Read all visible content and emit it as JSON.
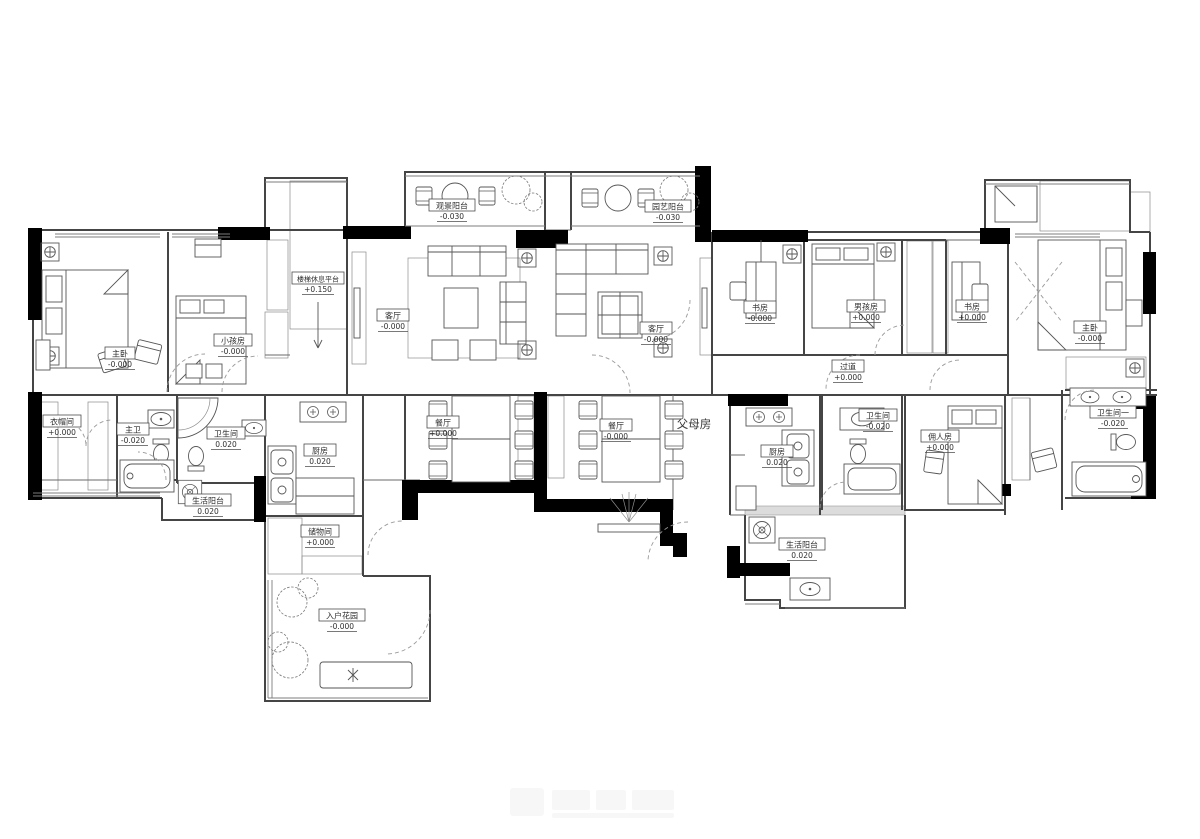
{
  "plan": {
    "rooms": {
      "master_left": {
        "name": "主卧",
        "elev": "-0.000"
      },
      "kids_room": {
        "name": "小孩房",
        "elev": "-0.000"
      },
      "stair_landing": {
        "name": "楼梯休息平台",
        "elev": "+0.150"
      },
      "view_balcony": {
        "name": "观景阳台",
        "elev": "-0.030"
      },
      "garden_balcony": {
        "name": "园艺阳台",
        "elev": "-0.030"
      },
      "living_left": {
        "name": "客厅",
        "elev": "-0.000"
      },
      "living_right": {
        "name": "客厅",
        "elev": "-0.000"
      },
      "study_left": {
        "name": "书房",
        "elev": "-0.000"
      },
      "boys_room": {
        "name": "男孩房",
        "elev": "+0.000"
      },
      "study_right": {
        "name": "书房",
        "elev": "+0.000"
      },
      "master_right": {
        "name": "主卧",
        "elev": "-0.000"
      },
      "hallway": {
        "name": "过道",
        "elev": "+0.000"
      },
      "cloakroom": {
        "name": "衣帽间",
        "elev": "+0.000"
      },
      "master_bath": {
        "name": "主卫",
        "elev": "-0.020"
      },
      "bath_left": {
        "name": "卫生间",
        "elev": "0.020"
      },
      "service_balcony_left": {
        "name": "生活阳台",
        "elev": "0.020"
      },
      "kitchen_left": {
        "name": "厨房",
        "elev": "0.020"
      },
      "storage": {
        "name": "储物间",
        "elev": "+0.000"
      },
      "entry_garden": {
        "name": "入户花园",
        "elev": "-0.000"
      },
      "dining_left": {
        "name": "餐厅",
        "elev": "+0.000"
      },
      "dining_right": {
        "name": "餐厅",
        "elev": "-0.000"
      },
      "kitchen_right": {
        "name": "厨房",
        "elev": "0.020"
      },
      "bath_right": {
        "name": "卫生间",
        "elev": "-0.020"
      },
      "maid_room": {
        "name": "佣人房",
        "elev": "+0.000"
      },
      "bath_one": {
        "name": "卫生间一",
        "elev": "-0.020"
      },
      "service_balcony_right": {
        "name": "生活阳台",
        "elev": "0.020"
      }
    },
    "annotations": {
      "parents_room": "父母房"
    },
    "colors": {
      "wall": "#454545",
      "poche": "#000000",
      "label_text": "#2e2e2e"
    }
  }
}
